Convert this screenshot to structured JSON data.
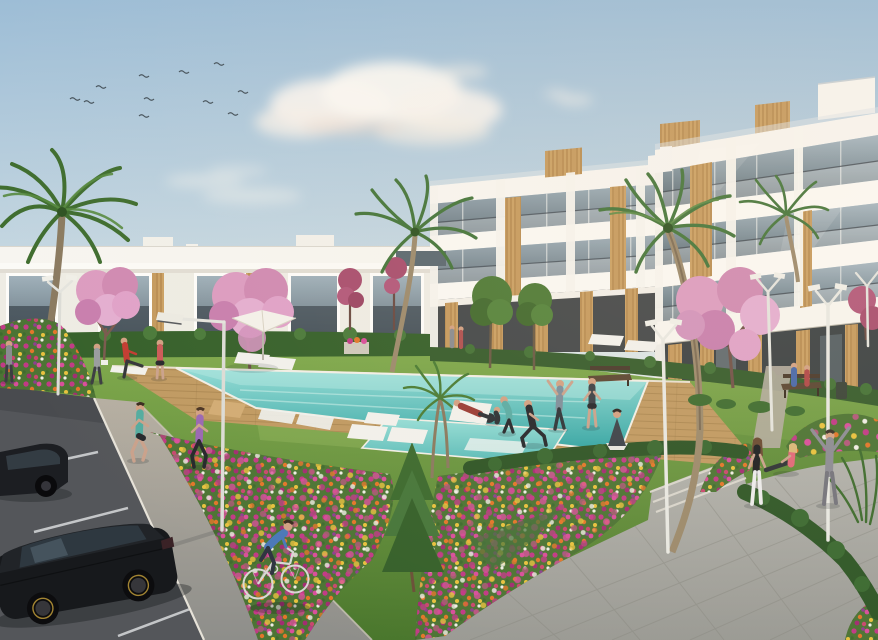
{
  "meta": {
    "title": "Exterior CGI render of a new-build residential complex with communal pool, gardens and parking",
    "width": 878,
    "height": 640
  },
  "palette": {
    "sky_top": "#9dbdd6",
    "sky_horizon": "#e3e9e5",
    "cloud": "#f7f3ee",
    "building_white": "#f7f5f0",
    "slab_white": "#fbf9f4",
    "glass_top": "#a6b6c0",
    "glass_bottom": "#55646c",
    "timber": "#c59a5e",
    "timber_dark": "#a87c42",
    "grass_light": "#7fa94c",
    "grass_dark": "#49762c",
    "hedge": "#35602a",
    "pool_shallow": "#93dcd6",
    "pool_deep": "#2fa3a2",
    "deck_wood": "#c09a62",
    "asphalt": "#54565a",
    "path_concrete": "#b6afa2",
    "walkway_stone": "#a8a8a2",
    "flower_bed_green": "#4c7434",
    "flower_magenta": "#c13a86",
    "flower_orange": "#e2762a",
    "flower_pink": "#d94f9b",
    "flower_yellow": "#e8c23e",
    "blossom_pink": "#d898c0",
    "blossom_deep": "#b2587a",
    "palm_green": "#4a7c34",
    "trunk_brown": "#9c8a6c",
    "lamp_white": "#e8e8e2",
    "car_black": "#17191c",
    "skin": "#d2a183"
  },
  "scene": {
    "sky": {
      "label": "soft blue afternoon sky",
      "bird_count": 11,
      "cloud_clusters": 4
    },
    "buildings": {
      "left": {
        "label": "low white apartment wing with dark glazed openings and roof terraces",
        "visible_floors": 1
      },
      "right_far": {
        "label": "far wing of white apartment block with glass balconies and timber piers",
        "visible_floors": 3
      },
      "right_near": {
        "label": "near wing of white apartment block with glass balconies, timber panels and rooftop penthouse",
        "visible_floors": 4
      }
    },
    "amenities": {
      "pool": {
        "label": "turquoise communal swimming pool with spa section and in-water loungers"
      },
      "deck": {
        "label": "timber pool deck"
      },
      "umbrella": {
        "label": "white parasol"
      },
      "sun_loungers": {
        "label": "white sun loungers",
        "count": 9
      },
      "street_lamps": {
        "label": "modern white street lamps",
        "count": 6
      },
      "benches": {
        "label": "park benches",
        "count": 2
      },
      "litter_bin": {
        "label": "litter bin"
      },
      "planter": {
        "label": "stone planter"
      }
    },
    "vegetation": {
      "palms": {
        "label": "palm trees",
        "count": 6
      },
      "blossom_trees": {
        "label": "pink blossom trees",
        "count": 5
      },
      "conifer": {
        "label": "young conifer"
      },
      "flower_beds": {
        "label": "mixed flower beds",
        "count": 6
      },
      "hedges": {
        "label": "clipped hedges"
      },
      "lawn": {
        "label": "communal lawn"
      }
    },
    "circulation": {
      "parking": {
        "label": "asphalt parking bays with white markings",
        "cars": 2
      },
      "jog_path": {
        "label": "concrete jogging path"
      },
      "walkway": {
        "label": "stone-tiled promenade with steps"
      },
      "steps": {
        "count": 3
      },
      "entry_path": {
        "label": "path to building entrance"
      }
    },
    "vehicles": {
      "car_main": {
        "label": "black hatchback parked diagonally"
      },
      "car_partial": {
        "label": "dark car at image edge"
      },
      "bicycle": {
        "label": "city bicycle"
      }
    },
    "people": [
      {
        "label": "pedestrian at far left",
        "clothing": "grey top"
      },
      {
        "label": "man walking with papers",
        "clothing": "grey shirt, dark trousers"
      },
      {
        "label": "man in red stretching on lounger",
        "clothing": "red shirt"
      },
      {
        "label": "woman standing in coral top",
        "clothing": "coral top, dark shorts"
      },
      {
        "label": "female jogger",
        "clothing": "teal top, black shorts"
      },
      {
        "label": "female jogger",
        "clothing": "purple top, black leggings"
      },
      {
        "label": "man stretching arms overhead",
        "clothing": "blue-grey shirt"
      },
      {
        "label": "man exercising",
        "clothing": "dark t-shirt, shorts"
      },
      {
        "label": "person lunging",
        "clothing": "black tracksuit"
      },
      {
        "label": "woman crouching",
        "clothing": "teal top, black leggings"
      },
      {
        "label": "person meditating cross-legged",
        "clothing": "dark top, white trousers"
      },
      {
        "label": "person crouched by a bag",
        "clothing": "dark clothes"
      },
      {
        "label": "cyclist",
        "clothing": "blue jumper, dark trousers"
      },
      {
        "label": "woman standing",
        "clothing": "black top, white leggings"
      },
      {
        "label": "woman sitting stretching",
        "clothing": "pink top, blonde hair"
      },
      {
        "label": "person with arms raised",
        "clothing": "grey tracksuit"
      },
      {
        "label": "couple seated on bench",
        "clothing": "blue and red tops"
      },
      {
        "label": "person reclining on lounger",
        "clothing": "dark red top"
      },
      {
        "label": "couple standing by planter",
        "clothing": "grey and red"
      }
    ]
  }
}
